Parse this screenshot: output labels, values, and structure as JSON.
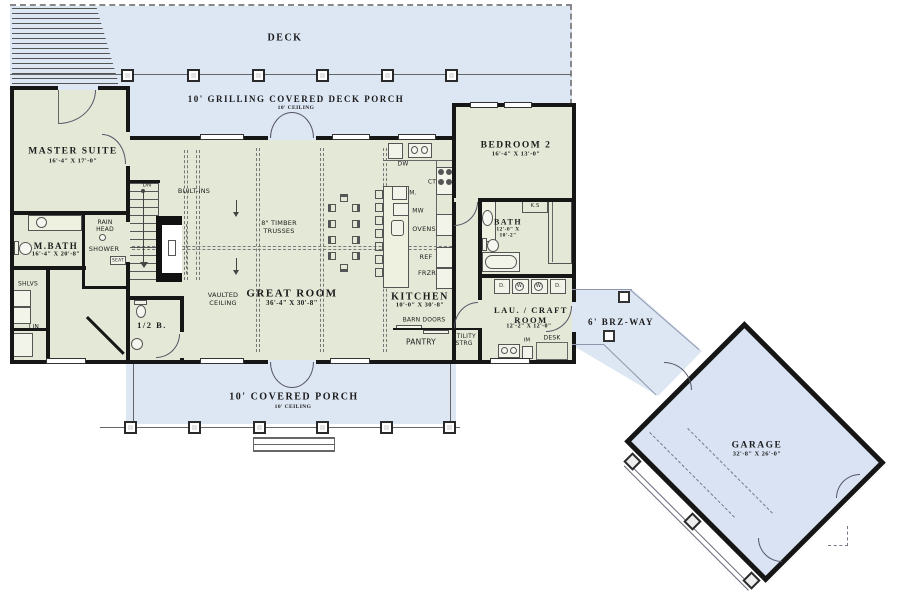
{
  "colors": {
    "floor_interior": "#e4e8d6",
    "floor_deck": "#dde6f3",
    "floor_garage": "#d9e3f3",
    "wall": "#161616"
  },
  "rooms": {
    "deck": {
      "name": "DECK"
    },
    "grilling_porch": {
      "name": "10' GRILLING COVERED DECK PORCH",
      "ceiling": "10' CEILING"
    },
    "master_suite": {
      "name": "MASTER SUITE",
      "dims": "16'-4\" X 17'-0\""
    },
    "m_bath": {
      "name": "M.BATH",
      "dims": "16'-4\" X 20'-8\""
    },
    "great_room": {
      "name": "GREAT ROOM",
      "dims": "36'-4\" X 30'-8\""
    },
    "kitchen": {
      "name": "KITCHEN",
      "dims": "10'-0\" X 30'-8\""
    },
    "bedroom_2": {
      "name": "BEDROOM 2",
      "dims": "16'-4\" X 13'-0\""
    },
    "bath_2": {
      "name": "BATH",
      "dims": "12'-0\" X\n10'-2\""
    },
    "lau_craft": {
      "name": "LAU. / CRAFT\nROOM",
      "dims": "12'-2\" X 12'-0\""
    },
    "half_bath": {
      "name": "1/2 B."
    },
    "brz_way": {
      "name": "6' BRZ-WAY"
    },
    "garage": {
      "name": "GARAGE",
      "dims": "32'-8\" X 26'-0\""
    },
    "covered_porch": {
      "name": "10' COVERED PORCH",
      "ceiling": "10' CEILING"
    }
  },
  "annotations": {
    "built_ins": "BUILT-INS",
    "timber_trusses": "8\" TIMBER\nTRUSSES",
    "vaulted_ceiling": "VAULTED\nCEILING",
    "barn_doors": "BARN DOORS",
    "pantry": "PANTRY",
    "utility_strg": "UTILITY\nSTRG",
    "rain_head": "RAIN\nHEAD",
    "shower": "SHOWER",
    "seat": "SEAT",
    "shlvs": "SHLVS",
    "lin": "LIN",
    "dn": "DN",
    "desk": "DESK",
    "im": "IM",
    "ks": "K.S",
    "dw": "DW",
    "ct": "CT",
    "mixer": "M.",
    "mw": "MW",
    "ovens": "OVENS",
    "ref": "REF",
    "frzr": "FRZR",
    "dryer_left": "D.",
    "washer_left": "W.",
    "washer_right": "W.",
    "dryer_right": "D."
  }
}
